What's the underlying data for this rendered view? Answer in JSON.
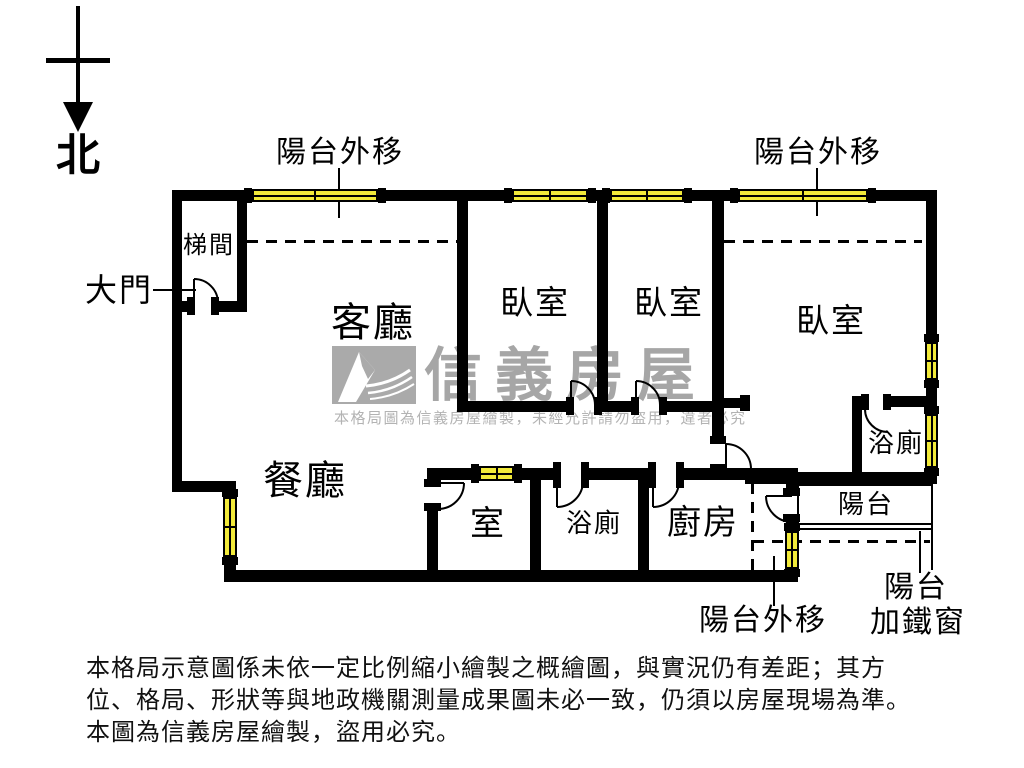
{
  "compass": {
    "label": "北"
  },
  "rooms": {
    "stairwell": "梯間",
    "living": "客廳",
    "dining": "餐廳",
    "bedroom1": "臥室",
    "bedroom2": "臥室",
    "bedroom3": "臥室",
    "small_room": "室",
    "bath1": "浴廁",
    "bath2": "浴廁",
    "kitchen": "廚房",
    "balcony": "陽台"
  },
  "annotations": {
    "balcony_out_top_left": "陽台外移",
    "balcony_out_top_right": "陽台外移",
    "balcony_out_bottom": "陽台外移",
    "main_door": "大門",
    "balcony_iron_line1": "陽台",
    "balcony_iron_line2": "加鐵窗"
  },
  "watermark": {
    "brand": "信義房屋",
    "notice": "本格局圖為信義房屋繪製，未經允許請勿盜用，違者必究"
  },
  "disclaimer": {
    "line1": "本格局示意圖係未依一定比例縮小繪製之概繪圖，與實況仍有差距；其方",
    "line2": "位、格局、形狀等與地政機關測量成果圖未必一致，仍須以房屋現場為準。",
    "line3": "本圖為信義房屋繪製，盜用必究。"
  },
  "colors": {
    "wall": "#000000",
    "window_fill": "#f2ea3a",
    "watermark_gray": "#a6a6a6"
  }
}
